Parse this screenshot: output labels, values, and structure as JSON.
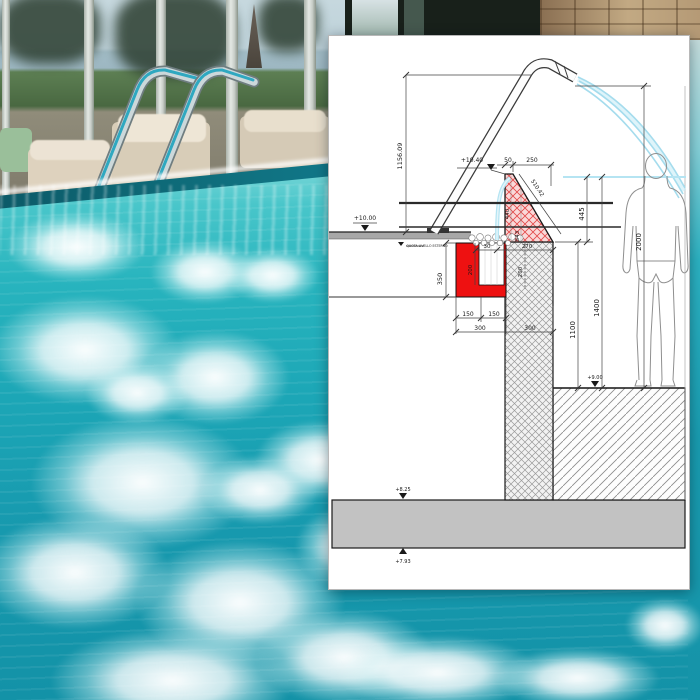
{
  "diagram": {
    "labels": {
      "cannon_height": "1156.09",
      "lvl_wall_top": "+10.40",
      "crest": "50",
      "offset": "250",
      "slope": "510.42",
      "wall_a": "440",
      "wall_b": "543",
      "drop": "445",
      "height_2000": "2000",
      "height_1400": "1400",
      "depth_1100": "1100",
      "lvl_deck": "+10.00",
      "note": "QUOTA LIVELLO ESTERNO",
      "gutter_350": "350",
      "red_200": "200",
      "hatch_200": "200",
      "lip_30": "30",
      "base_270": "270",
      "g150a": "150",
      "g150b": "150",
      "w300a": "300",
      "w300b": "300",
      "lvl_floor": "+9.00",
      "lvl_slab_top": "+8.25",
      "lvl_slab_bot": "+7.93"
    },
    "colors": {
      "highlight_red": "#ee1111",
      "wall_pink": "#fad8d8",
      "jet_cyan": "#a5dced",
      "slab_gray": "#c2c2c2",
      "deck_gray": "#a8a8a8"
    }
  },
  "photo": {
    "colors": {
      "water_teal": "#1ba6b6",
      "foam_white": "#ffffff",
      "stone_tan": "#b59a76"
    }
  }
}
